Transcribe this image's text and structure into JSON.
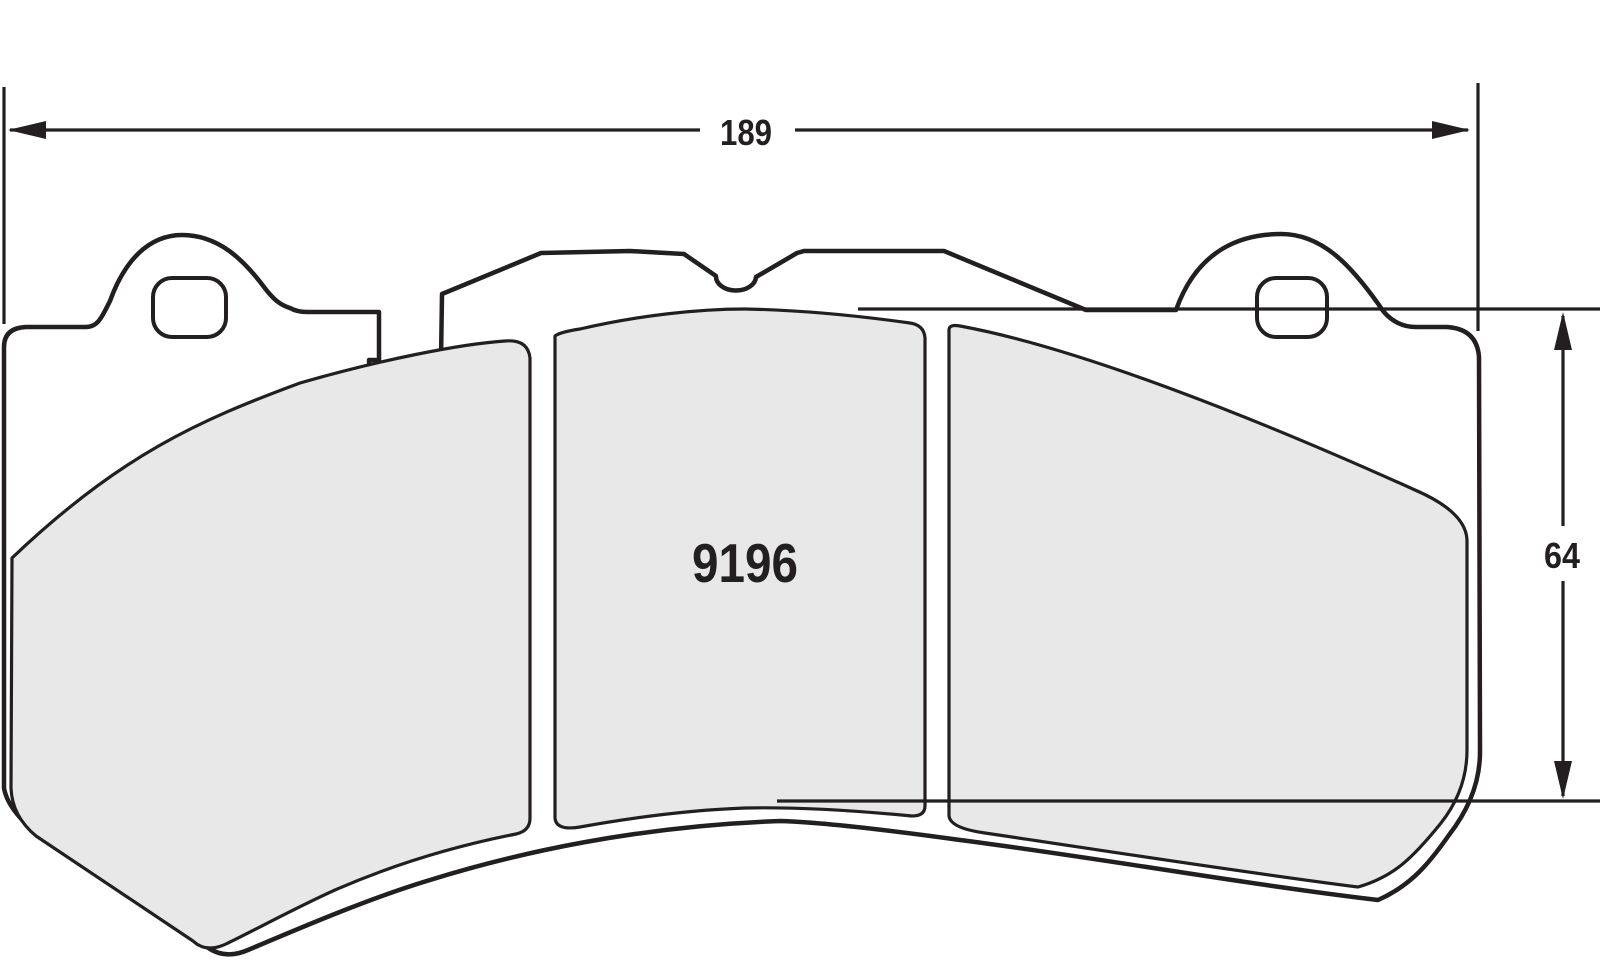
{
  "drawing": {
    "type": "brake-pad-outline-technical-drawing",
    "part_number": "9196",
    "dimensions": {
      "width": {
        "value": "189",
        "orientation": "horizontal",
        "position": "top"
      },
      "height": {
        "value": "64",
        "orientation": "vertical",
        "position": "right"
      }
    },
    "colors": {
      "line": "#231f20",
      "friction_fill": "#e8e8e9",
      "backing_fill": "#ffffff",
      "background": "#ffffff"
    }
  }
}
